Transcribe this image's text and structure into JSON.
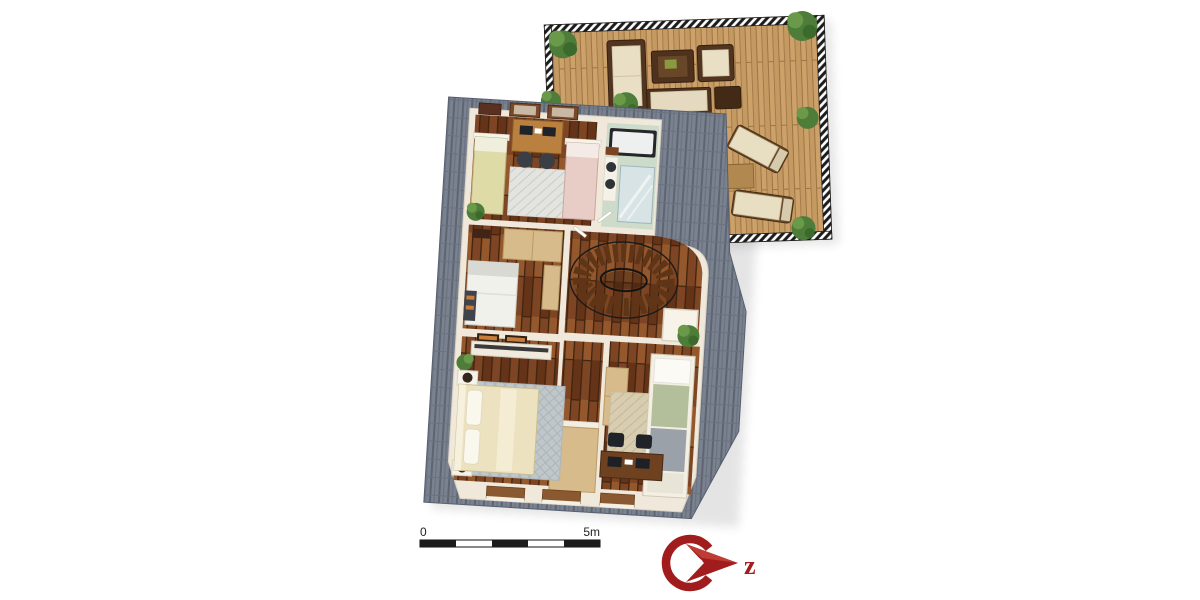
{
  "scale_bar": {
    "start_label": "0",
    "end_label": "5m",
    "segments": 5,
    "meters_total": 5
  },
  "logo": {
    "icon": "compass-north-arrow-icon",
    "letter": "z"
  },
  "floor_plan": {
    "type": "3d-rendered-top-down-floor-plan",
    "rooms": [
      {
        "name": "kids-bedroom",
        "furniture": [
          "single-bed-yellow",
          "single-bed-pink",
          "computer-desk",
          "two-desk-chairs",
          "rug",
          "plant",
          "wall-pictures"
        ]
      },
      {
        "name": "bathroom",
        "furniture": [
          "bathtub",
          "glass-shower",
          "double-sink-counter"
        ]
      },
      {
        "name": "stair-hall",
        "furniture": [
          "curved-staircase",
          "white-side-table",
          "plant"
        ]
      },
      {
        "name": "guest-room",
        "furniture": [
          "single-bed-white",
          "wardrobe",
          "tall-shelf",
          "wall-pictures"
        ]
      },
      {
        "name": "landing",
        "furniture": [
          "sideboard",
          "wall-pictures",
          "wooden-table"
        ]
      },
      {
        "name": "master-bedroom",
        "furniture": [
          "double-bed-cream",
          "nightstand-with-lamp-left",
          "nightstand-with-lamp-right",
          "gray-rug",
          "plant"
        ]
      },
      {
        "name": "bedroom",
        "furniture": [
          "single-bed-green-gray",
          "wardrobe",
          "beige-rug",
          "computer-desk",
          "two-desk-chairs"
        ]
      },
      {
        "name": "roof-terrace",
        "furniture": [
          "outdoor-sofa",
          "coffee-table",
          "armchair",
          "bench",
          "ottoman",
          "sun-lounger-upper",
          "sun-lounger-lower",
          "wooden-side-table",
          "corner-bushes",
          "hatched-railing"
        ]
      }
    ]
  },
  "colors": {
    "background": "#ffffff",
    "roof-base": "#7a8290",
    "roof-dark": "#5d6573",
    "roof-mid": "#6a7280",
    "wall-cream": "#f0e9db",
    "floor-wood": "#7d4523",
    "floor-wood-light": "#9a5c2e",
    "floor-wood-dark": "#653317",
    "plank-gap": "#3f2410",
    "deck-wood": "#c49a62",
    "deck-wood-light": "#cda26a",
    "deck-gap": "#9d7443",
    "bathroom-floor": "#cddbcb",
    "glass-blue": "#d7e3e4",
    "bed-yellow": "#dfdba6",
    "bed-pink": "#e7cdc6",
    "bed-cream": "#ece2c0",
    "blanket-green": "#b3bf9b",
    "blanket-gray": "#9aa1a8",
    "rug-light": "#e3e4df",
    "rug-gray": "#c0c7ca",
    "rug-beige": "#d8cdb0",
    "furniture-dark": "#523521",
    "furniture-brown": "#b9803f",
    "furniture-light": "#d8bb8a",
    "plant-green": "#4e7d3a",
    "plant-green-light": "#6a994a",
    "plant-green-dark": "#3c6a2c",
    "accent-red": "#a11d1d",
    "accent-red-light": "#c34238",
    "text-dark": "#222222"
  }
}
